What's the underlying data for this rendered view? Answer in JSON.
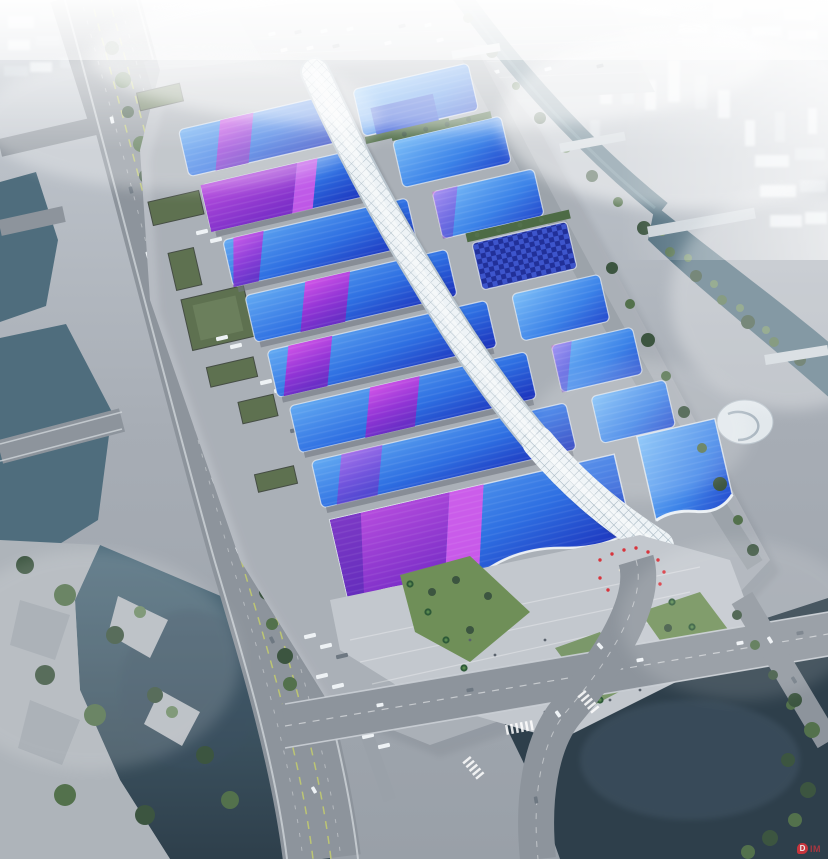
{
  "meta": {
    "type": "aerial architectural rendering",
    "subject": "riverside exhibition and convention center complex in haze"
  },
  "watermark": {
    "badge": "D",
    "text": "IM"
  },
  "colors": {
    "ground1": "#c6ccd3",
    "ground2": "#a7adb5",
    "ground3": "#99a0a8",
    "apron": "#b6bbc2",
    "road": "#8d949c",
    "road_dark": "#7a8189",
    "road_edge": "#cfd4d9",
    "lane_yellow": "#d6df5e",
    "water_light": "#73919c",
    "water_mid": "#4f6d7d",
    "water_dark": "#2e3f4b",
    "roof_a1": "#63aaf2",
    "roof_a2": "#2e6fe2",
    "roof_a3": "#1b2fba",
    "roof_b1": "#7fc0f8",
    "roof_b2": "#3b82e8",
    "roof_b3": "#2448cc",
    "ribbon1": "#d958ea",
    "ribbon2": "#9335d6",
    "ribbon3": "#6a2ec6",
    "purple_a": "#bb4fe0",
    "purple_b": "#7c2fc8",
    "navy1": "#213099",
    "navy2": "#3d55cc",
    "tree_dark": "#3c5540",
    "tree_mid": "#53714c",
    "tree_light": "#6c8a64",
    "lawn": "#6f8f58",
    "palm_dark": "#2e5a38",
    "palm_light": "#5a8a50",
    "spine": "#eef3f6",
    "spine_edge": "#b9c5ce",
    "lattice": "#a3b4bf",
    "fog": "#ffffff",
    "city1": "#e4e9ed",
    "city2": "#cdd4da",
    "white": "#f1f4f6",
    "crowd_red": "#d8343c",
    "wall": "#6f7781",
    "shadow": "#2e3640",
    "truck_white": "#eef2f5",
    "people": "#5a626c"
  },
  "scene": {
    "features": [
      {
        "name": "exhibition-halls",
        "desc": "two ranks of halls with wavy blue roofs crossed by magenta-violet diagonal sashes"
      },
      {
        "name": "central-spine-corridor",
        "desc": "white diamond-lattice serpentine concourse running the length of the complex"
      },
      {
        "name": "entrance-hall",
        "desc": "wave-roofed south entrance with stepped palm-lined plaza and visitor crowd with red umbrellas"
      },
      {
        "name": "west-expressway",
        "desc": "multi-lane expressway and tree-lined avenue with bus and truck parking"
      },
      {
        "name": "waterways",
        "desc": "canals and river basins bordering the site with pedestrian bridges"
      },
      {
        "name": "city-skyline",
        "desc": "white high-rise district fading into fog to the north and east"
      },
      {
        "name": "north-parking",
        "desc": "large surface car park at the north end of the site"
      }
    ]
  }
}
